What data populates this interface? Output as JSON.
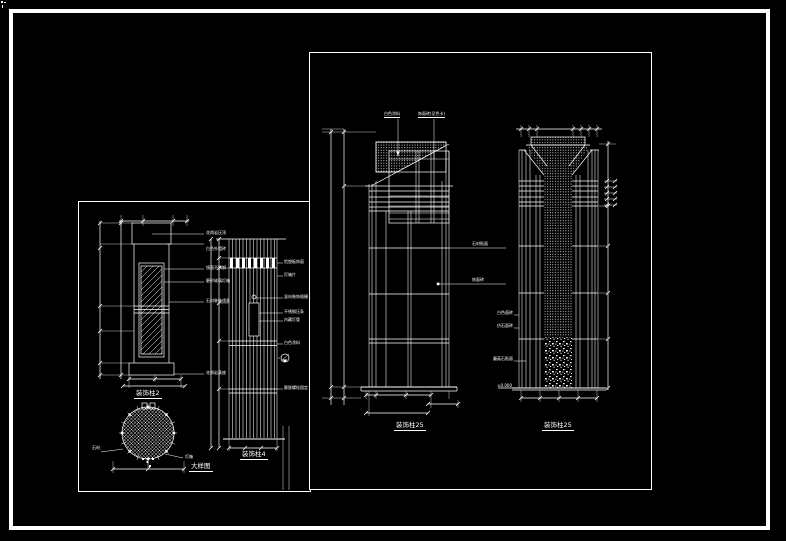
{
  "window": {
    "background": "#000000",
    "line_color": "#ffffff"
  },
  "left_sheet": {
    "titles": {
      "elevation": "装饰柱2",
      "plan": "大样图",
      "detail": "装饰柱4"
    },
    "elevation_labels": [
      "花岗岩压顶",
      "白色外墙砖",
      "镜面不锈钢",
      "磨砂玻璃灯箱",
      "石材装饰线条",
      "花岗岩基座"
    ],
    "plan_labels": [
      "石材",
      "灯箱"
    ],
    "detail_labels": [
      "铝塑板饰面",
      "灯箱片",
      "竖向装饰格栅",
      "不锈钢压条",
      "内藏灯管",
      "白色涂料",
      "膨胀螺栓固定"
    ]
  },
  "right_sheet": {
    "left_column": {
      "top_labels": [
        "白色涂料",
        "饰面砖(见色卡)"
      ],
      "side_labels": [
        "石材贴面",
        "饰面砖"
      ],
      "title": "装饰柱25"
    },
    "right_column": {
      "side_labels": [
        "白色面砖",
        "仿石面砖",
        "蘑菇石贴面",
        "±0.000"
      ],
      "title": "装饰柱25"
    }
  }
}
